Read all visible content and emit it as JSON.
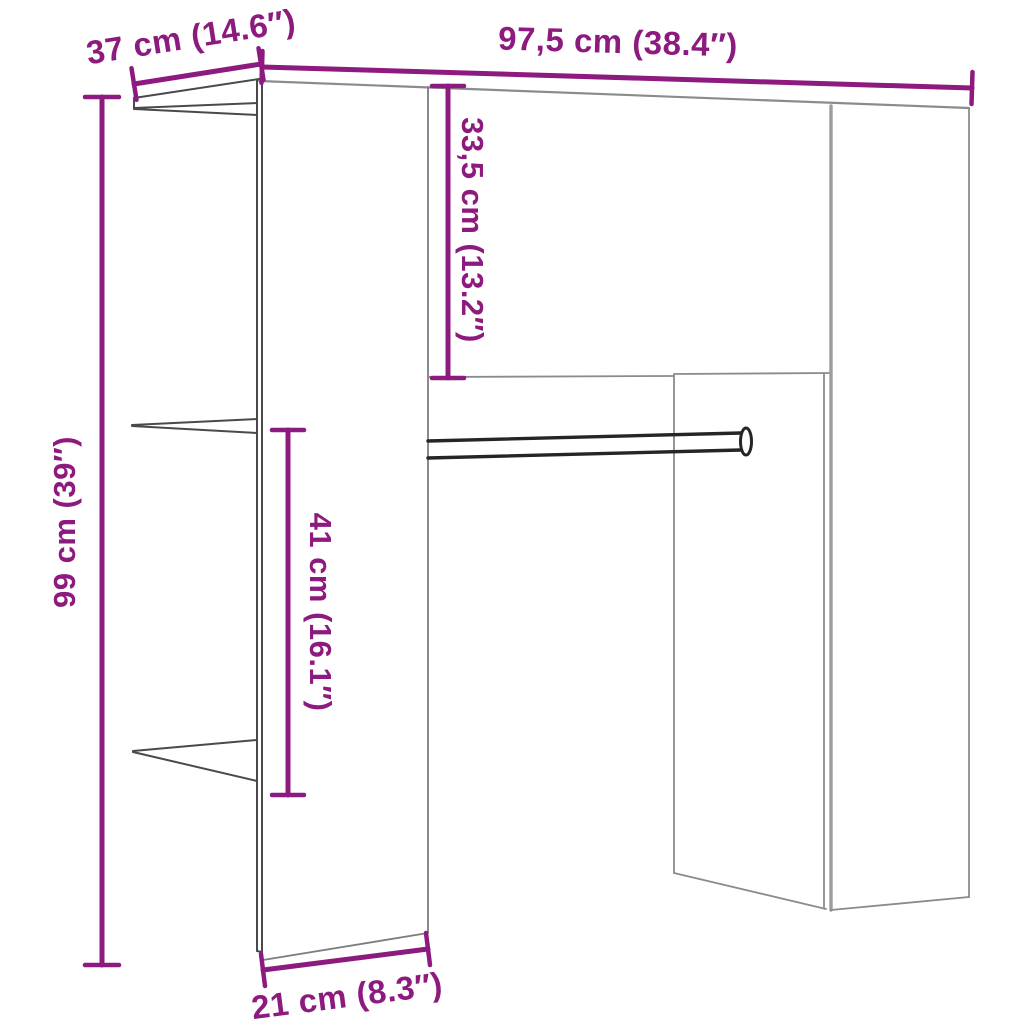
{
  "diagram": {
    "title": "hallway-unit-dimension-diagram",
    "accent_color": "#8d1a7e",
    "furniture_line_color": "#58585a",
    "unit_system": "cm / inches",
    "dimensions": {
      "depth_top": {
        "label": "37 cm (14.6″)",
        "cm": 37,
        "inches": 14.6,
        "measures": "top depth of side panel"
      },
      "width": {
        "label": "97,5 cm (38.4″)",
        "cm": 97.5,
        "inches": 38.4,
        "measures": "overall width"
      },
      "cabinet_height": {
        "label": "33,5 cm (13.2″)",
        "cm": 33.5,
        "inches": 13.2,
        "measures": "overhead cabinet height"
      },
      "total_height": {
        "label": "99 cm (39″)",
        "cm": 99,
        "inches": 39,
        "measures": "overall height"
      },
      "rail_drop": {
        "label": "41 cm (16.1″)",
        "cm": 41,
        "inches": 16.1,
        "measures": "shelf to rail clearance"
      },
      "depth_bottom": {
        "label": "21 cm (8.3″)",
        "cm": 21,
        "inches": 8.3,
        "measures": "bottom depth of panel"
      }
    }
  }
}
